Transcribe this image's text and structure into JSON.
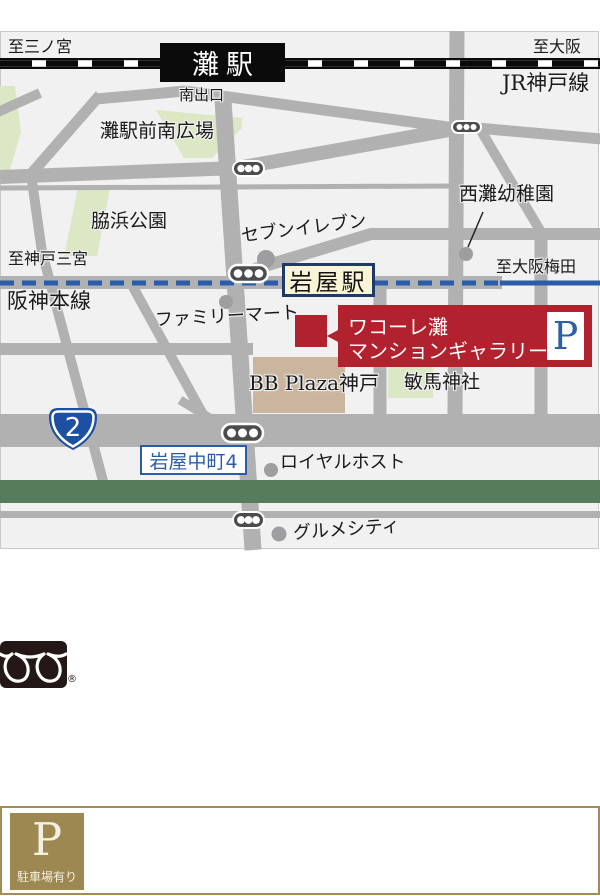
{
  "map": {
    "labels": {
      "to_sannomiya": "至三ノ宮",
      "to_osaka": "至大阪",
      "jr_kobe_line": "JR神戸線",
      "nada_station": "灘駅",
      "south_exit": "南出口",
      "nada_plaza": "灘駅前南広場",
      "wakihama_park": "脇浜公園",
      "seven_eleven": "セブンイレブン",
      "nishinada_kindergarten": "西灘幼稚園",
      "to_kobe_sannomiya": "至神戸三宮",
      "to_osaka_umeda": "至大阪梅田",
      "hanshin_main_line": "阪神本線",
      "iwaya_station": "岩屋駅",
      "family_mart": "ファミリーマート",
      "bb_plaza_kobe": "BB Plaza神戸",
      "minume_shrine": "敏馬神社",
      "route2_number": "2",
      "iwaya_nakamachi_4": "岩屋中町4",
      "royal_host": "ロイヤルホスト",
      "gourmet_city": "グルメシティ"
    },
    "gallery": {
      "line1": "ワコーレ灘",
      "line2": "マンションギャラリー",
      "parking_mark": "P"
    },
    "colors": {
      "accent_red": "#b2212e",
      "hanshin_blue": "#2a5ca8",
      "road_gray": "#b1b1b2",
      "park_green": "#dbe7c5",
      "band_green": "#567c5c",
      "building_tan": "#cab69f",
      "station_cream": "#faf4d6",
      "station_navy": "#1f3a68",
      "shield_blue": "#1d50a2",
      "gold": "#9d8851"
    }
  },
  "footer": {
    "registered_mark": "®"
  },
  "parking_box": {
    "p": "P",
    "label": "駐車場有り"
  }
}
